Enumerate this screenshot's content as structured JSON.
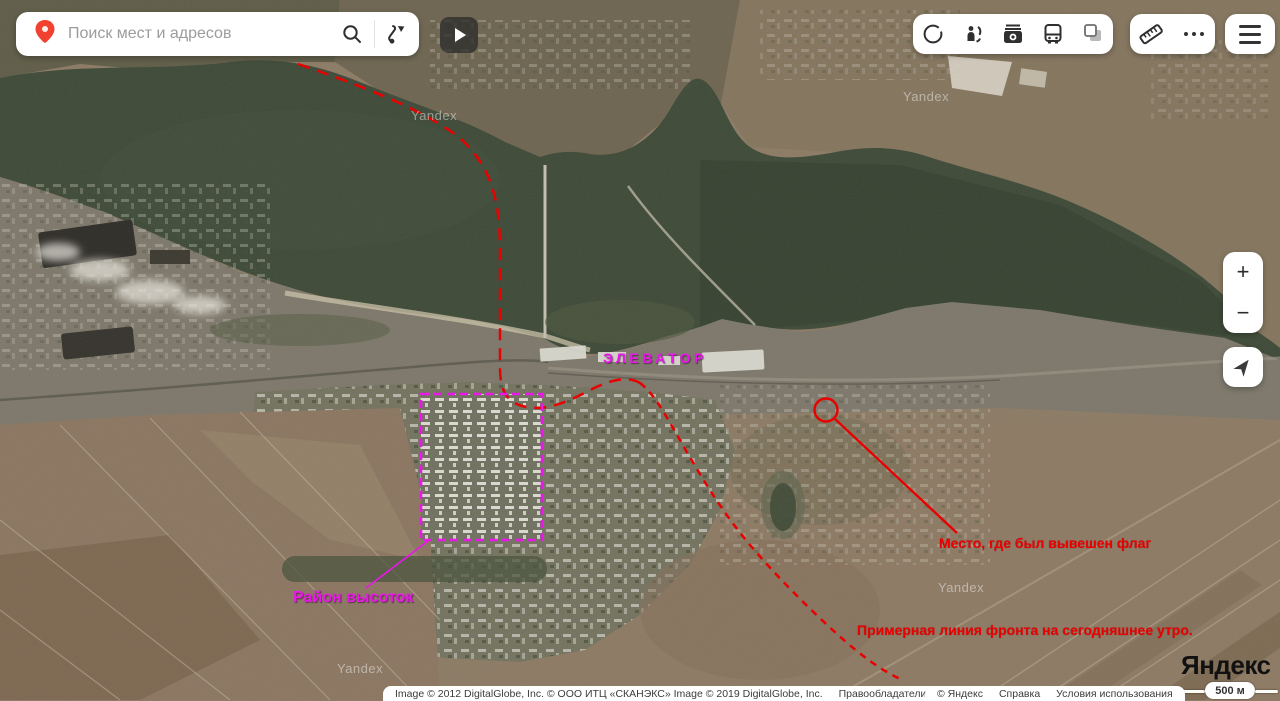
{
  "search": {
    "placeholder": "Поиск мест и адресов"
  },
  "toolbar": {
    "icons": [
      "panoramas",
      "mirrors",
      "photos",
      "transport",
      "layers"
    ],
    "measure_icon": "ruler",
    "more_icon": "ellipsis",
    "menu_icon": "hamburger"
  },
  "zoom_controls": {
    "zoom_in": "+",
    "zoom_out": "−"
  },
  "annotations": {
    "elevator": "ЭЛЕВАТОР",
    "district": "Район высоток",
    "flag": "Место, где был вывешен флаг",
    "frontline": "Примерная линия фронта на сегодняшнее утро."
  },
  "watermark": "Yandex",
  "logo": "Яндекс",
  "scale": {
    "label": "500 м"
  },
  "attribution": {
    "imagery": "Image © 2012 DigitalGlobe, Inc. © ООО ИТЦ «СКАНЭКС» Image © 2019 DigitalGlobe, Inc.",
    "rights": "Правообладатели",
    "copyright": "© Яндекс",
    "help": "Справка",
    "terms": "Условия использования"
  },
  "colors": {
    "annotation_red": "#e90000",
    "annotation_magenta": "#ea16ea",
    "pin": "#f14130"
  }
}
